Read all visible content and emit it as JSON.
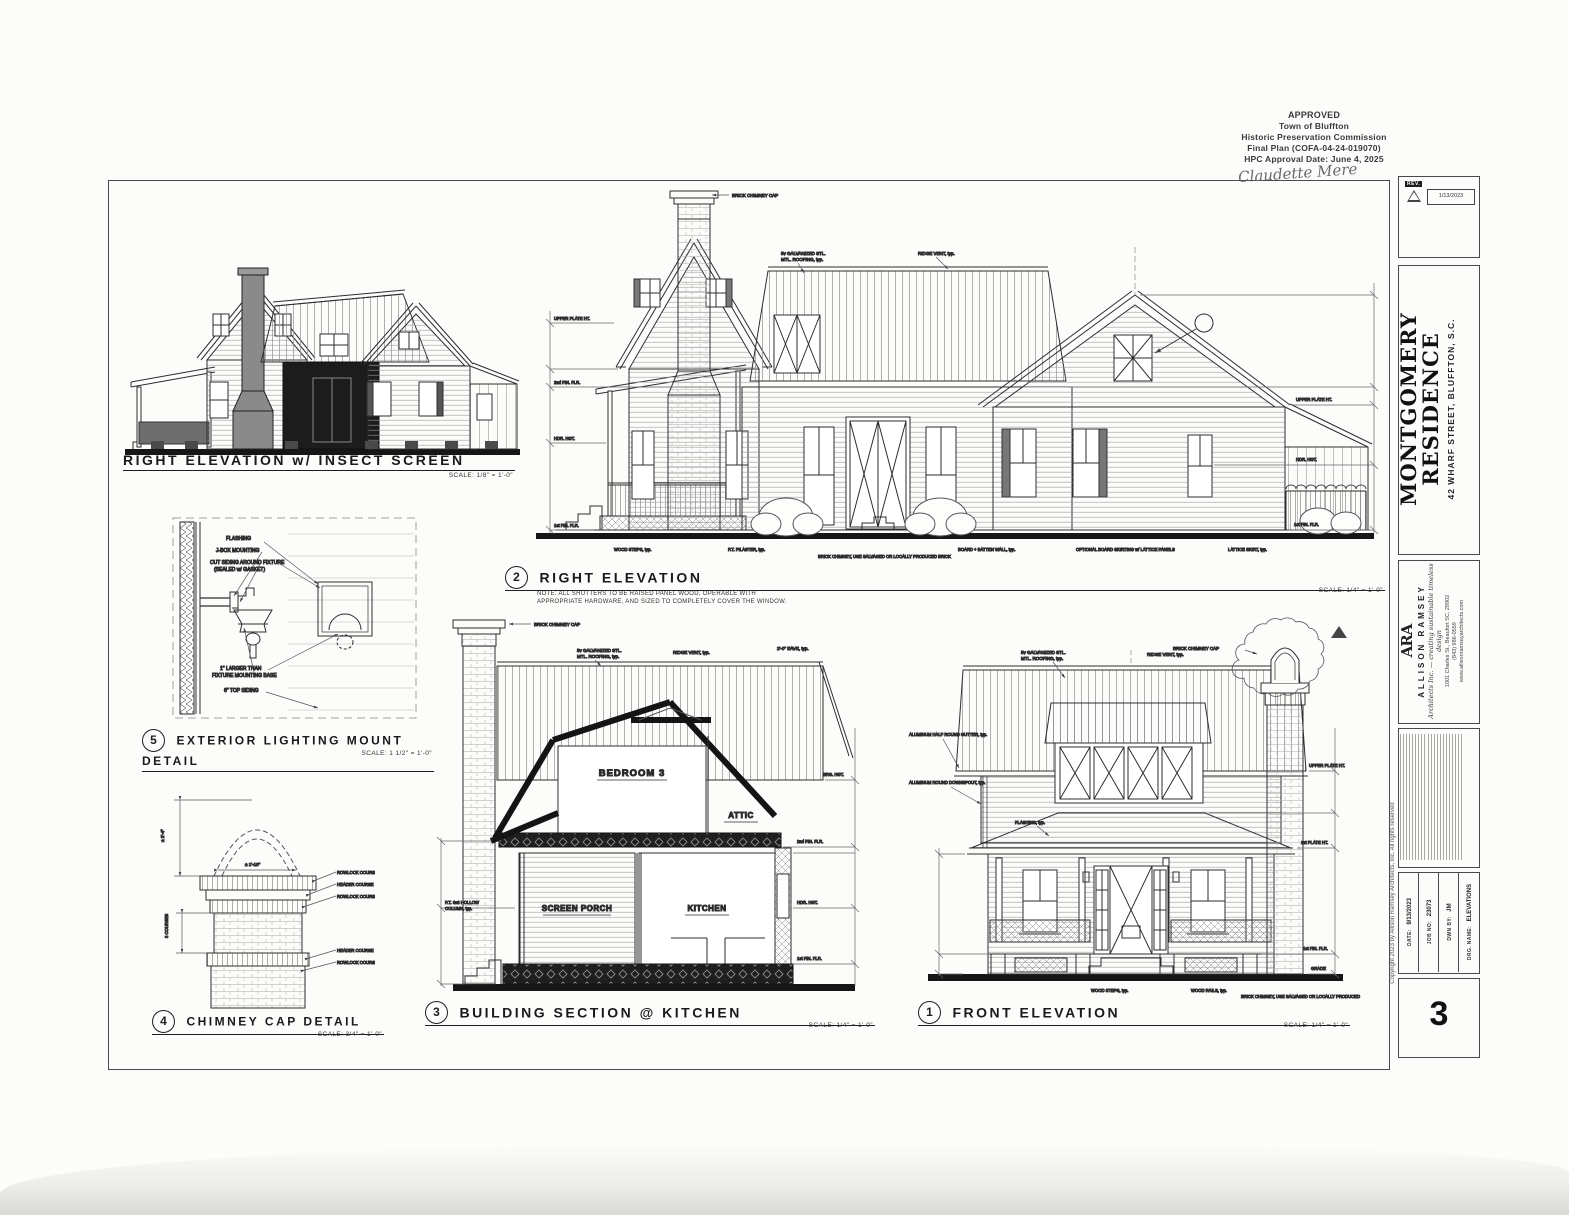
{
  "approval": {
    "title": "APPROVED",
    "line2": "Town of Bluffton",
    "line3": "Historic Preservation Commission",
    "line4": "Final Plan (COFA-04-24-019070)",
    "line5": "HPC Approval Date: June 4, 2025",
    "signature": "Claudette Mere"
  },
  "views": {
    "insect_elevation": {
      "title": "RIGHT ELEVATION w/ INSECT SCREEN",
      "scale": "SCALE: 1/8\" = 1'-0\""
    },
    "right_elevation": {
      "number": "2",
      "title": "RIGHT ELEVATION",
      "scale": "SCALE: 1/4\" = 1'-0\"",
      "note1": "NOTE: ALL SHUTTERS TO BE RAISED PANEL WOOD, OPERABLE WITH",
      "note2": "APPROPRIATE HARDWARE, AND SIZED TO COMPLETELY COVER THE WINDOW."
    },
    "lighting_detail": {
      "number": "5",
      "title": "EXTERIOR LIGHTING MOUNT DETAIL",
      "scale": "SCALE: 1 1/2\" = 1'-0\"",
      "labels": {
        "flashing": "FLASHING",
        "jbox": "J-BOX MOUNTING",
        "cut1": "CUT SIDING AROUND FIXTURE",
        "cut2": "(SEALED w/ GASKET)",
        "base1": "1\" LARGER THAN",
        "base2": "FIXTURE MOUNTING BASE",
        "siding": "6\" TOP SIDING"
      }
    },
    "chimney_detail": {
      "number": "4",
      "title": "CHIMNEY CAP DETAIL",
      "scale": "SCALE: 3/4\" = 1'-0\"",
      "courses": [
        "ROWLOCK COURSE",
        "HEADER COURSE",
        "ROWLOCK COURSE",
        "HEADER COURSE",
        "ROWLOCK COURSE"
      ],
      "dim_height": "± 2'-4\"",
      "dim_width": "± 1'-10\"",
      "dim_courses": "3 COURSES"
    },
    "building_section": {
      "number": "3",
      "title": "BUILDING SECTION @ KITCHEN",
      "scale": "SCALE: 1/4\" = 1'-0\"",
      "rooms": {
        "bedroom": "BEDROOM 3",
        "attic": "ATTIC",
        "porch": "SCREEN PORCH",
        "kitchen": "KITCHEN"
      }
    },
    "front_elevation": {
      "number": "1",
      "title": "FRONT ELEVATION",
      "scale": "SCALE: 1/4\" = 1'-0\""
    }
  },
  "notes": {
    "chimney_cap": "BRICK CHIMNEY CAP",
    "ridge_vent": "RIDGE VENT, typ.",
    "metal1": "5v GALVANIZED STL.",
    "metal2": "MTL. ROOFING, typ.",
    "gutter": "ALUMINUM HALF ROUND GUTTER, typ.",
    "downspout": "ALUMINUM ROUND DOWNSPOUT, typ.",
    "flashing": "FLASHING, typ.",
    "wood_steps": "WOOD STEPS, typ.",
    "wood_rails": "WOOD RAILS, typ.",
    "pt_pilaster": "P.T. PILASTER, typ.",
    "salvaged_brick": "BRICK CHIMNEY, USE SALVAGED OR LOCALLY PRODUCED BRICK",
    "board_batten": "BOARD + BATTEN WALL, typ.",
    "optional_skirt": "OPTIONAL BOARD SKIRTING w/ LATTICE PANELS",
    "lattice_skirt": "LATTICE SKIRT, typ.",
    "hollow_col1": "P.T. 6x6 HOLLOW",
    "hollow_col2": "COLUMN, typ.",
    "eave_dim": "2'-0\" EAVE, typ."
  },
  "marks": [
    "UPPER PLATE HT.",
    "BRG. HGT.",
    "HDR. HGT.",
    "2nd FIN. FLR.",
    "1st PLATE HT.",
    "1st FIN. FLR.",
    "GRADE"
  ],
  "titleblock": {
    "revision": {
      "label": "REV.",
      "date": "1/13/2023"
    },
    "project": {
      "name1": "MONTGOMERY",
      "name2": "RESIDENCE",
      "address": "42 WHARF STREET, BLUFFTON, S.C."
    },
    "architect": {
      "logo": "ARA",
      "name": "ALLISON RAMSEY",
      "tagline": "Architects Inc. — creating sustainable timeless design",
      "address": "1001 Charles St., Beaufort SC, 29902",
      "phone": "(843) 986-0559",
      "web": "www.allisonramseyarchitects.com"
    },
    "info": {
      "date_label": "DATE:",
      "date": "9/13/2023",
      "job_label": "JOB NO:",
      "job": "23073",
      "dwn_label": "DWN BY:",
      "dwn": "JM",
      "drg_label": "DRG. NAME:",
      "drg": "ELEVATIONS"
    },
    "sheet_number": "3",
    "copyright": "Copyright 2023 by Allison Ramsey Architects, Inc.     All rights reserved"
  }
}
